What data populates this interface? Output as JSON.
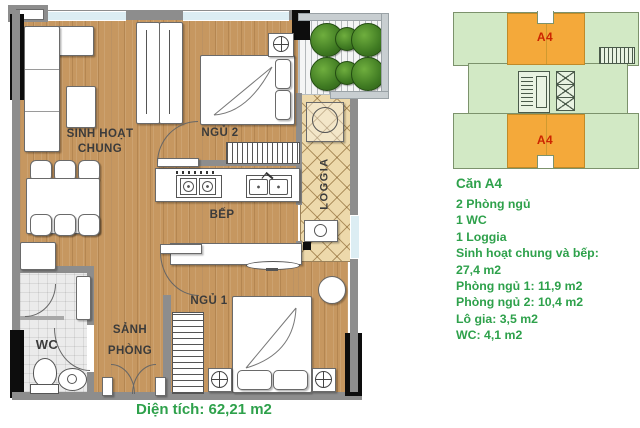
{
  "floor_plan": {
    "labels": {
      "living_1": "SINH HOẠT",
      "living_2": "CHUNG",
      "bedroom2": "NGỦ 2",
      "kitchen": "BẾP",
      "loggia": "LOGGIA",
      "bedroom1": "NGỦ 1",
      "hall_1": "SẢNH",
      "hall_2": "PHÒNG",
      "wc": "WC"
    },
    "area_note": "Diện tích: 62,21 m2"
  },
  "key_plan": {
    "unit_top": "A4",
    "unit_bottom": "A4"
  },
  "unit_info": {
    "title": "Căn A4",
    "lines": [
      "2 Phòng ngủ",
      "1 WC",
      "1 Loggia",
      "Sinh hoạt chung và bếp:",
      "27,4 m2",
      "Phòng ngủ 1: 11,9 m2",
      "Phòng ngủ 2: 10,4 m2",
      "Lô gia: 3,5 m2",
      "WC: 4,1 m2"
    ]
  },
  "colors": {
    "info_text": "#2ea14b",
    "unit_highlight": "#f4a93a",
    "key_plan_floor": "#d2e9c5",
    "unit_label_text": "#cc2500",
    "wood_floor": "#c69760",
    "loggia_tile": "#edd9ab",
    "wall": "#8d8d8d",
    "window_glass": "#dcedf3"
  }
}
